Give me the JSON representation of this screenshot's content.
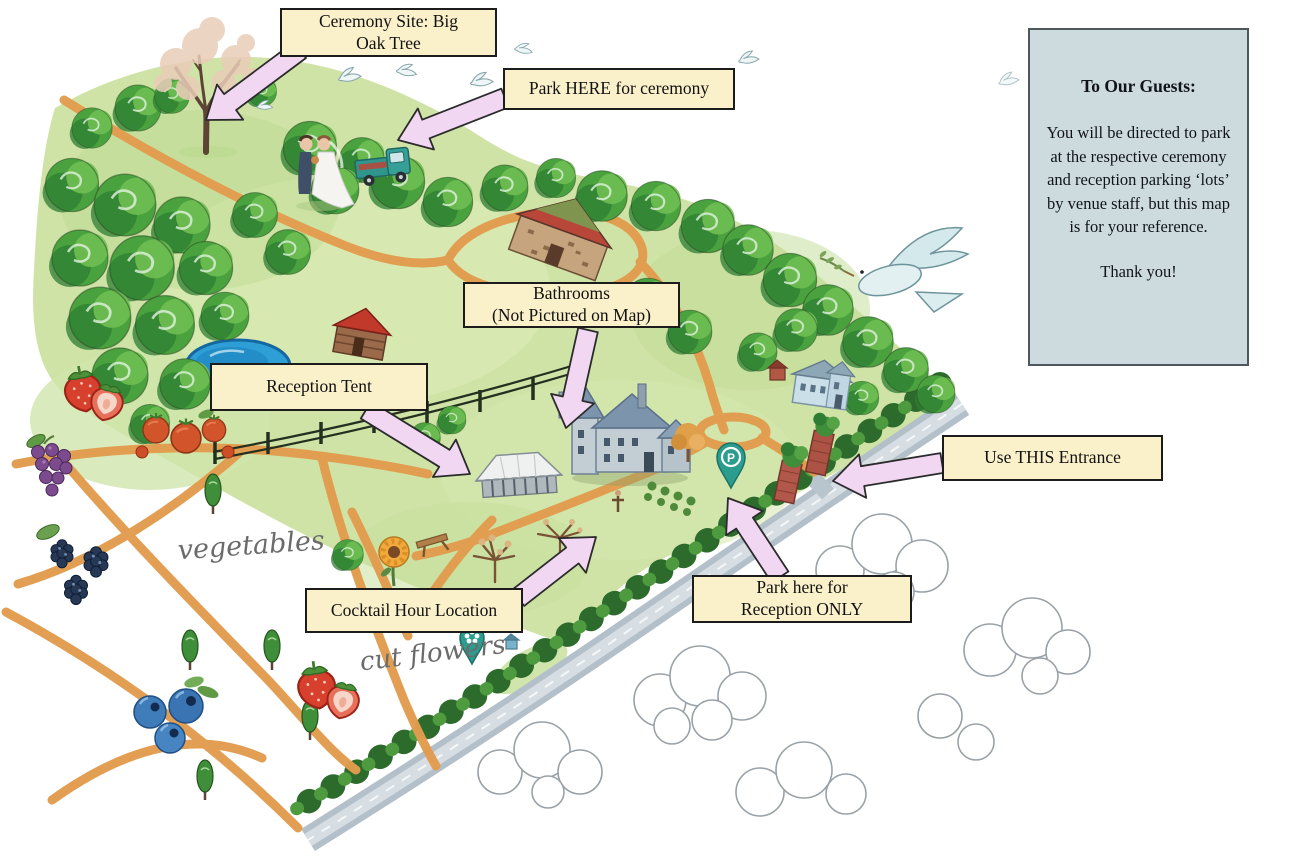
{
  "callouts": {
    "ceremony_site": "Ceremony Site: Big\nOak Tree",
    "park_ceremony": "Park HERE for ceremony",
    "bathrooms": "Bathrooms\n(Not Pictured on Map)",
    "reception_tent": "Reception Tent",
    "use_entrance": "Use THIS Entrance",
    "park_reception": "Park here for\nReception ONLY",
    "cocktail_hour": "Cocktail Hour Location"
  },
  "info_box": {
    "title": "To Our Guests:",
    "body": "You will be directed to park at the respective ceremony and reception parking ‘lots’ by venue staff, but this map is for your reference.",
    "closing": "Thank you!"
  },
  "map_labels": {
    "vegetables": "vegetables",
    "cut_flowers": "cut flowers",
    "parking_pin": "P"
  },
  "colors": {
    "callout_bg": "#faf0ca",
    "callout_border": "#1c1c1c",
    "arrow_fill": "#f1d7f2",
    "info_bg": "#cddbdf",
    "info_border": "#4e585c",
    "meadow_green": "#cfe3a6",
    "tree_green": "#4aa23e",
    "path_orange": "#e29c4e",
    "pond_blue": "#2d9fd6",
    "road_gray": "#b3c0c9",
    "pin_teal": "#2a9d8f",
    "canvas_bg": "#ffffff"
  },
  "illustration_features": [
    "big-oak-tree",
    "bride-and-groom",
    "pickup-truck",
    "doves",
    "dove-with-olive-branch",
    "tree-border",
    "pond",
    "stone-barn",
    "log-cabin",
    "main-farmhouse",
    "blue-farmhouse",
    "reception-tent",
    "split-rail-fence",
    "brick-entrance-pillars",
    "parking-pin",
    "flower-pin",
    "sunflower",
    "picnic-table",
    "autumn-trees",
    "orange-paths",
    "roundabout",
    "farm-beds",
    "grapes",
    "blackberries",
    "blueberries",
    "strawberries",
    "tomatoes",
    "hedge-row",
    "country-road",
    "clouds"
  ]
}
